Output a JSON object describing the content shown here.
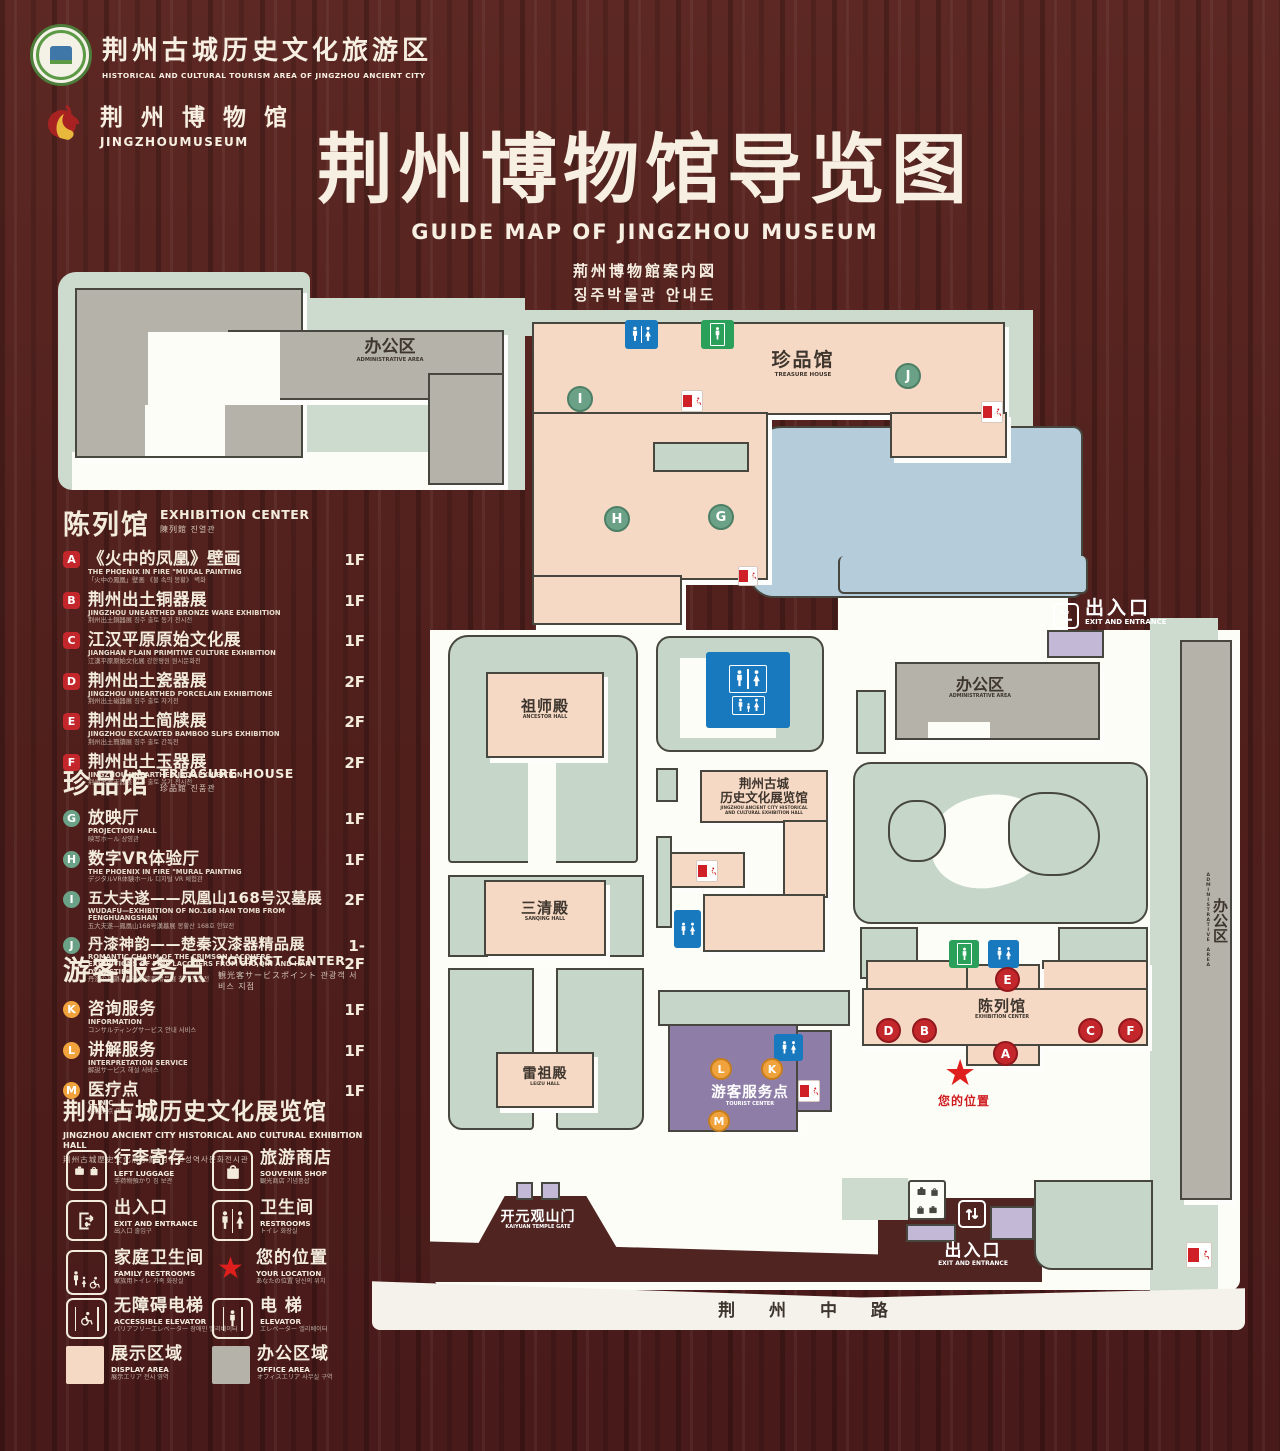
{
  "header": {
    "logo1": {
      "zh": "荆州古城历史文化旅游区",
      "en": "HISTORICAL AND CULTURAL TOURISM AREA OF JINGZHOU ANCIENT CITY"
    },
    "logo2": {
      "zh": "荆 州 博 物 馆",
      "en": "JINGZHOUMUSEUM"
    },
    "title_zh": "荆州博物馆导览图",
    "title_en": "GUIDE MAP OF JINGZHOU MUSEUM",
    "title_ja": "荊州博物館案内図",
    "title_ko": "징주박물관 안내도"
  },
  "legend": {
    "exhibition": {
      "zh": "陈列馆",
      "en": "EXHIBITION CENTER",
      "sub": "陳列館  진열관",
      "items": [
        {
          "letter": "A",
          "zh": "《火中的凤凰》壁画",
          "en": "THE PHOENIX IN FIRE \"MURAL PAINTING",
          "sub": "「火中の鳳凰」壁画 《불 속의 봉황》 벽화",
          "floor": "1F"
        },
        {
          "letter": "B",
          "zh": "荆州出土铜器展",
          "en": "JINGZHOU UNEARTHED BRONZE WARE EXHIBITION",
          "sub": "荆州出土銅器展  징주 출토 동기 전시전",
          "floor": "1F"
        },
        {
          "letter": "C",
          "zh": "江汉平原原始文化展",
          "en": "JIANGHAN PLAIN PRIMITIVE CULTURE EXHIBITION",
          "sub": "江漢平原原始文化展  강한평원 원시문화전",
          "floor": "1F"
        },
        {
          "letter": "D",
          "zh": "荆州出土瓷器展",
          "en": "JINGZHOU UNEARTHED PORCELAIN EXHIBITIONE",
          "sub": "荆州出土磁器展  징주 출토 자기전",
          "floor": "2F"
        },
        {
          "letter": "E",
          "zh": "荆州出土简牍展",
          "en": "JINGZHOU EXCAVATED BAMBOO SLIPS EXHIBITION",
          "sub": "荆州出土簡牘展  징주 출토 간독전",
          "floor": "2F"
        },
        {
          "letter": "F",
          "zh": "荆州出土玉器展",
          "en": "JINGZHOU UNEARTHED JADE EXHIBITION",
          "sub": "荆州出土玉器展  징주 출토 옥기 전시전",
          "floor": "2F"
        }
      ]
    },
    "treasure": {
      "zh": "珍品馆",
      "en": "TREASURE HOUSE",
      "sub": "珍品館  진품관",
      "items": [
        {
          "letter": "G",
          "zh": "放映厅",
          "en": "PROJECTION HALL",
          "sub": "映写ホール  상영관",
          "floor": "1F"
        },
        {
          "letter": "H",
          "zh": "数字VR体验厅",
          "en": "THE PHOENIX IN FIRE \"MURAL PAINTING",
          "sub": "デジタルVR体験ホール  디지털 VR 체험관",
          "floor": "1F"
        },
        {
          "letter": "I",
          "zh": "五大夫遂——凤凰山168号汉墓展",
          "en": "WUDAFU—EXHIBITION OF NO.168 HAN TOMB FROM FENGHUANGSHAN",
          "sub": "五大夫遂—鳳凰山168号漢墓展  봉황산 168호 한묘전",
          "floor": "2F"
        },
        {
          "letter": "J",
          "zh": "丹漆神韵——楚秦汉漆器精品展",
          "en": "ROMANTIC CHARM OF THE CRIMSON LACQUERS— EXHIBITIONS OF FINE LACQUERS FROM CHU,QIN AND HAN DYNASTIES",
          "sub": "丹漆の神韻—楚秦漢漆器精品展  칠기 정품전",
          "floor": "1-2F"
        }
      ]
    },
    "tourist": {
      "zh": "游客服务点",
      "en": "TOURIST CENTER",
      "sub": "観光客サービスポイント  관광객 서비스 지점",
      "items": [
        {
          "letter": "K",
          "zh": "咨询服务",
          "en": "INFORMATION",
          "sub": "コンサルティングサービス  안내 서비스",
          "floor": "1F"
        },
        {
          "letter": "L",
          "zh": "讲解服务",
          "en": "INTERPRETATION SERVICE",
          "sub": "解説サービス  해설 서비스",
          "floor": "1F"
        },
        {
          "letter": "M",
          "zh": "医疗点",
          "en": "CLINIC",
          "sub": "医療拠点  의료점",
          "floor": "1F"
        }
      ]
    },
    "hall_title": {
      "zh": "荆州古城历史文化展览馆",
      "en": "JINGZHOU ANCIENT CITY HISTORICAL AND CULTURAL EXHIBITION HALL",
      "sub": "荆州古城歴史文化展示館    징주고성역사문화전시관"
    },
    "icons": [
      {
        "zh": "行李寄存",
        "en": "LEFT LUGGAGE",
        "sub": "手荷物預かり  짐 보관"
      },
      {
        "zh": "旅游商店",
        "en": "SOUVENIR SHOP",
        "sub": "観光商店  기념품샵"
      },
      {
        "zh": "出入口",
        "en": "EXIT AND ENTRANCE",
        "sub": "出入口  출입구"
      },
      {
        "zh": "卫生间",
        "en": "RESTROOMS",
        "sub": "トイレ  화장실"
      },
      {
        "zh": "家庭卫生间",
        "en": "FAMILY RESTROOMS",
        "sub": "家族用トイレ  가족 화장실"
      },
      {
        "zh": "您的位置",
        "en": "YOUR LOCATION",
        "sub": "あなたの位置  당신의 위치"
      },
      {
        "zh": "无障碍电梯",
        "en": "ACCESSIBLE ELEVATOR",
        "sub": "バリアフリーエレベーター  장애인 엘리베이터"
      },
      {
        "zh": "电  梯",
        "en": "ELEVATOR",
        "sub": "エレベーター  엘리베이터"
      },
      {
        "zh": "展示区域",
        "en": "DISPLAY AREA",
        "sub": "展示エリア  전시 영역"
      },
      {
        "zh": "办公区域",
        "en": "OFFICE AREA",
        "sub": "オフィスエリア  사무실 구역"
      }
    ]
  },
  "map": {
    "admin_top_left": {
      "zh": "办公区",
      "en": "ADMINISTRATIVE AREA"
    },
    "treasure_house": {
      "zh": "珍品馆",
      "en": "TREASURE HOUSE"
    },
    "ancestor_hall": {
      "zh": "祖师殿",
      "en": "ANCESTOR HALL"
    },
    "sanqing_hall": {
      "zh": "三清殿",
      "en": "SANQING HALL"
    },
    "leizu_hall": {
      "zh": "雷祖殿",
      "en": "LEIZU HALL"
    },
    "exhibition_hall": {
      "zh1": "荆州古城",
      "zh2": "历史文化展览馆",
      "en1": "JINGZHOU ANCIENT CITY HISTORICAL",
      "en2": "AND CULTURAL EXHIBITION HALL"
    },
    "tourist_center": {
      "zh": "游客服务点",
      "en": "TOURIST CENTER"
    },
    "exhibition_center": {
      "zh": "陈列馆",
      "en": "EXHIBITION CENTER"
    },
    "admin_right": {
      "zh": "办公区",
      "en": "ADMINISTRATIVE AREA"
    },
    "admin_strip": {
      "zh": "办公区",
      "en": "ADMINISTRATIVE AREA"
    },
    "gate": {
      "zh": "开元观山门",
      "en": "KAIYUAN TEMPLE GATE"
    },
    "exit_top": {
      "zh": "出入口",
      "en": "EXIT AND ENTRANCE"
    },
    "exit_bottom": {
      "zh": "出入口",
      "en": "EXIT AND ENTRANCE"
    },
    "your_location": {
      "zh": "您的位置"
    },
    "road": {
      "zh": "荆 州 中 路"
    },
    "markers": {
      "A": "A",
      "B": "B",
      "C": "C",
      "D": "D",
      "E": "E",
      "F": "F",
      "G": "G",
      "H": "H",
      "I": "I",
      "J": "J",
      "K": "K",
      "L": "L",
      "M": "M"
    },
    "star_glyph": "★"
  },
  "colors": {
    "wood": "#4f1f1c",
    "mint": "#ccdbcd",
    "display_pink": "#f6d9c4",
    "office_gray": "#b5b2a9",
    "pond_blue": "#b5cdda",
    "tourist_purple": "#8e7da6",
    "gate_lavender": "#c3b8d6",
    "badge_red": "#c4272b",
    "badge_green": "#6ba287",
    "badge_orange": "#f0a33c",
    "sign_blue": "#1879bf",
    "sign_green": "#2aa05a",
    "location_red": "#df1f1d",
    "cream_text": "#f3ecdd"
  }
}
